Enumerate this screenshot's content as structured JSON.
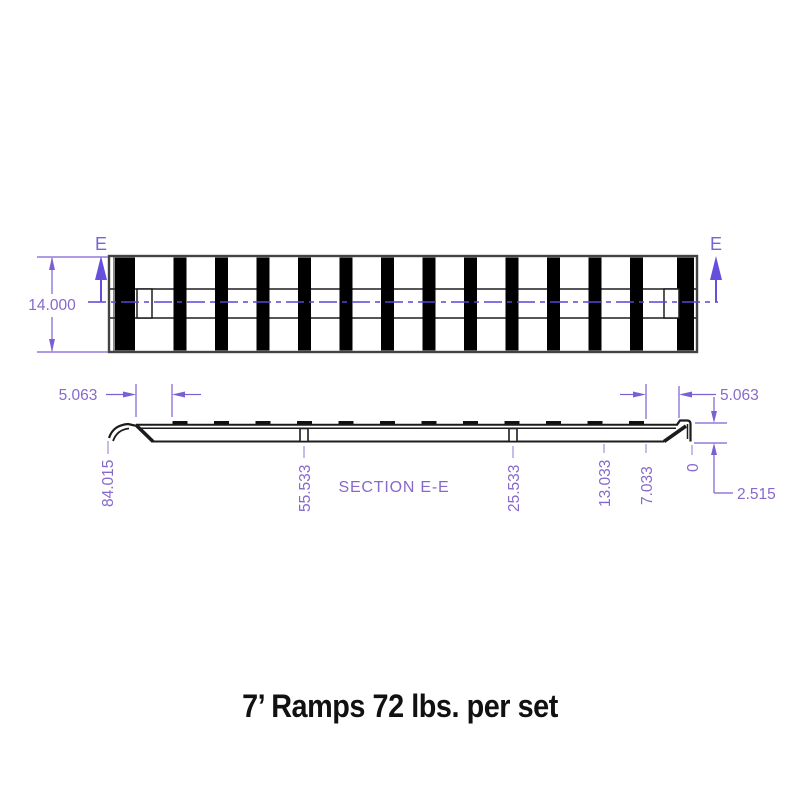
{
  "title": {
    "text": "7’ Ramps 72 lbs. per set"
  },
  "colors": {
    "dimension_text": "#8769cb",
    "dimension_line": "#7d5fd4",
    "centerline": "#5646d6",
    "drawing_line": "#1c1c1c",
    "stripe_fill": "#000000"
  },
  "top_view": {
    "section_label": "E",
    "width_dim": "14.000"
  },
  "section_view": {
    "name": "SECTION E-E",
    "left_offset_dim": "5.063",
    "right_offset_dim": "5.063",
    "drop_dim": "2.515",
    "station_labels": [
      "84.015",
      "55.533",
      "25.533",
      "13.033",
      "7.033",
      "0"
    ]
  }
}
